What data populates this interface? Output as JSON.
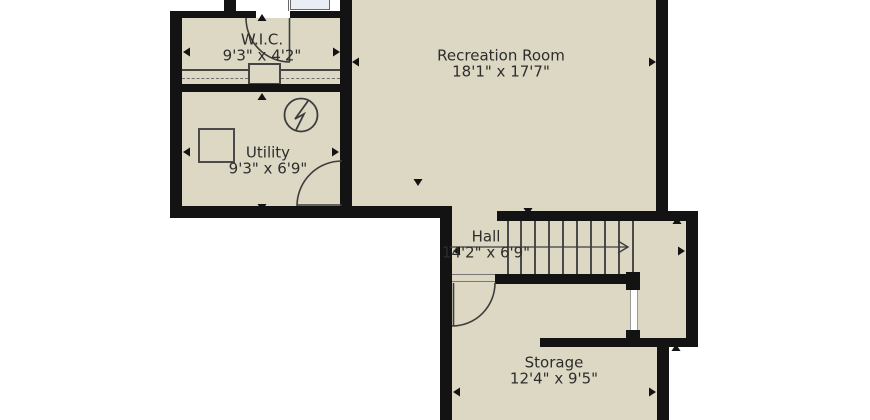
{
  "plan": {
    "rooms": [
      {
        "id": "wic",
        "label": "W.I.C.",
        "dimensions": "9'3\" x 4'2\""
      },
      {
        "id": "utility",
        "label": "Utility",
        "dimensions": "9'3\" x 6'9\""
      },
      {
        "id": "recreation",
        "label": "Recreation Room",
        "dimensions": "18'1\" x 17'7\""
      },
      {
        "id": "hall",
        "label": "Hall",
        "dimensions": "14'2\" x 6'9\""
      },
      {
        "id": "storage",
        "label": "Storage",
        "dimensions": "12'4\" x 9'5\""
      }
    ],
    "symbols": [
      {
        "id": "water-heater-symbol",
        "description": "circle with zigzag bolt in Utility room"
      },
      {
        "id": "utility-appliance",
        "description": "square appliance outline in Utility room"
      },
      {
        "id": "vanity-counter",
        "description": "light blue counter fixture at cropped top edge"
      },
      {
        "id": "staircase",
        "description": "straight staircase, direction arrow pointing right",
        "treads": 10
      },
      {
        "id": "wic-closet",
        "description": "closet shelf line with dashed hanging-rod lines"
      }
    ],
    "doors": [
      {
        "id": "wic-door",
        "description": "swing door at W.I.C. top wall"
      },
      {
        "id": "utility-door",
        "description": "swing door between Utility and Recreation Room"
      },
      {
        "id": "storage-door",
        "description": "swing door between Hall and Storage"
      }
    ],
    "colors": {
      "floor": "#dcd8c3",
      "wall": "#131313",
      "outside": "#ffffff",
      "line": "#454545",
      "fixture": "#e9eef5",
      "text": "#2d2d2d"
    }
  }
}
